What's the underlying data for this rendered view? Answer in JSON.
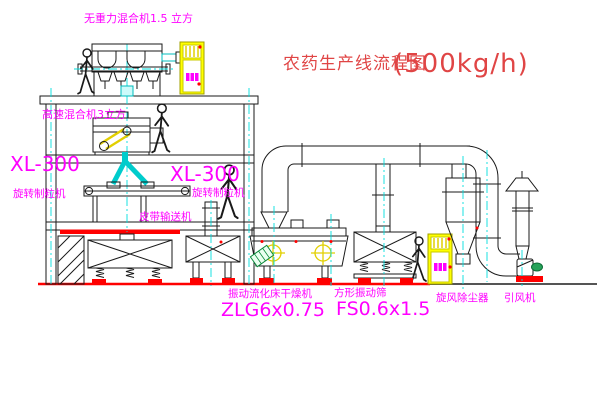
{
  "title": {
    "name": "农药生产线流程图",
    "capacity": "(500kg/h)"
  },
  "equipment_labels": {
    "gravity_mixer": "无重力混合机1.5 立方",
    "high_speed_mixer": "高速混合机3立方",
    "granulator_left_model": "XL-300",
    "granulator_left_name": "旋转制粒机",
    "granulator_mid_model": "XL-300",
    "granulator_mid_name": "旋转制粒机",
    "belt_conveyor": "皮带输送机",
    "fluid_bed_dryer_name": "振动流化床干燥机",
    "fluid_bed_dryer_model": "ZLG6x0.75",
    "square_sieve_name": "方形振动筛",
    "square_sieve_model": "FS0.6x1.5",
    "cyclone": "旋风除尘器",
    "induced_fan": "引风机"
  },
  "colors": {
    "label_magenta": "#ff00ff",
    "title_red": "#e04545",
    "centerline_cyan": "#00dddd",
    "cabinet_yellow": "#ffff00",
    "ground_red": "#ff0000",
    "motor_green": "#27a35a",
    "line_black": "#1a1a1a"
  },
  "icons": {
    "person-icon": "walking-worker-outline",
    "control-cabinet-icon": "yellow-electric-control-cabinet",
    "cyclone-icon": "cyclone-dust-separator",
    "exhaust-stack-icon": "stack-with-rain-cap",
    "fan-icon": "centrifugal-fan-with-motor"
  }
}
